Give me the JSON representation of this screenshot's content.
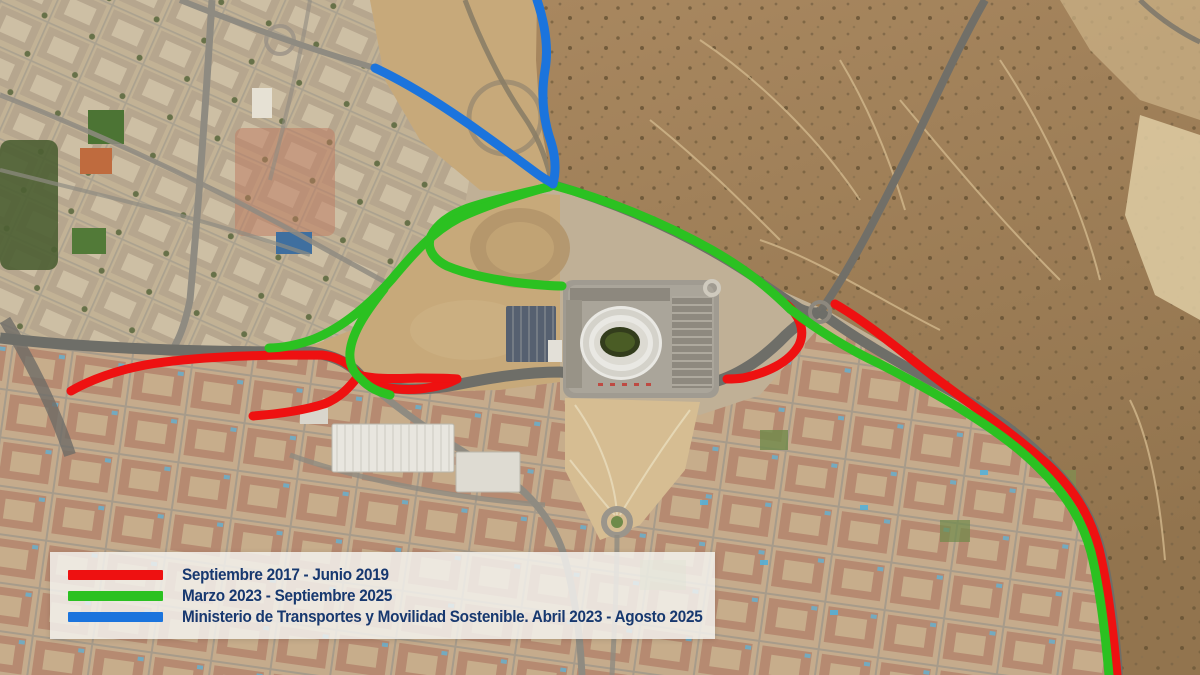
{
  "legend": {
    "items": [
      {
        "label": "Septiembre 2017 - Junio 2019",
        "color": "#ee1111"
      },
      {
        "label": "Marzo 2023 - Septiembre 2025",
        "color": "#2bc121"
      },
      {
        "label": "Ministerio de Transportes y Movilidad Sostenible. Abril 2023 - Agosto 2025",
        "color": "#1b74dd"
      }
    ]
  },
  "map": {
    "type": "satellite-route-overlay",
    "colors": {
      "red": "#ee1111",
      "green": "#2bc121",
      "blue": "#1b74dd"
    },
    "routes": [
      {
        "id": "red-west-upper",
        "color": "red",
        "width": 9,
        "path": "M 71 391 C 95 377 130 366 165 362 C 220 355 280 355 322 355 C 340 357 351 365 359 375 C 372 387 398 391 420 389 C 438 387 450 383 457 379"
      },
      {
        "id": "red-west-lower",
        "color": "red",
        "width": 9,
        "path": "M 253 416 C 278 414 305 410 324 404 C 340 398 350 387 359 375 C 371 379 395 379 418 378 C 433 378 448 378 457 379"
      },
      {
        "id": "red-stadium-curve",
        "color": "red",
        "width": 9,
        "path": "M 786 304 C 799 315 806 330 799 345 C 789 363 766 373 743 378 C 736 379 730 379 727 379"
      },
      {
        "id": "red-m40-southeast",
        "color": "red",
        "width": 9,
        "path": "M 835 304 C 858 317 885 338 915 362 C 960 398 1010 430 1047 464 C 1077 492 1091 519 1099 549 C 1108 586 1113 629 1117 675"
      },
      {
        "id": "green-m40-highway",
        "color": "green",
        "width": 9,
        "path": "M 553 185 C 605 199 662 222 712 250 C 745 269 768 287 790 309 C 820 332 850 350 880 364 C 930 390 1000 428 1039 468 C 1069 497 1083 523 1091 552 C 1100 588 1105 630 1109 675"
      },
      {
        "id": "green-loop",
        "color": "green",
        "width": 9,
        "path": "M 549 187 C 522 193 492 200 468 208 C 449 215 437 224 431 236 C 426 248 433 259 447 266 C 466 274 494 280 521 283 C 539 285 553 286 562 286"
      },
      {
        "id": "green-diagonal",
        "color": "green",
        "width": 9,
        "path": "M 551 186 C 515 196 484 206 459 218 C 432 232 412 255 392 279 C 372 302 344 327 314 339 C 298 345 281 348 269 348"
      },
      {
        "id": "green-south-branch",
        "color": "green",
        "width": 9,
        "path": "M 384 289 C 369 308 352 331 350 352 C 349 364 354 373 361 379 C 369 388 379 392 390 395"
      },
      {
        "id": "blue-north-branch",
        "color": "blue",
        "width": 9,
        "path": "M 537 0 C 545 24 549 47 545 70 C 541 94 543 119 551 142 C 556 158 556 172 553 184"
      },
      {
        "id": "blue-west-branch",
        "color": "blue",
        "width": 9,
        "path": "M 375 68 C 403 81 434 100 463 120 C 492 140 520 161 539 175 C 546 180 551 182 553 184"
      }
    ]
  }
}
